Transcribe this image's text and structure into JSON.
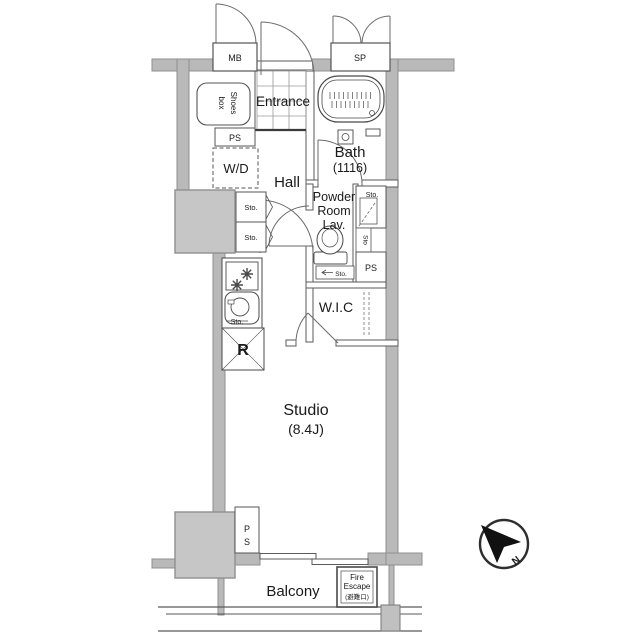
{
  "plan": {
    "type": "apartment-floor-plan",
    "colors": {
      "wall_fill": "#b9b9b9",
      "wall_edge": "#8f8f8f",
      "pillar_fill": "#c6c6c6",
      "line": "#3a3a3a",
      "text": "#1a1a1a",
      "background": "#ffffff"
    },
    "rooms": {
      "entrance": "Entrance",
      "hall": "Hall",
      "bath": "Bath",
      "bath_size": "(1116)",
      "powder_line1": "Powder",
      "powder_line2": "Room",
      "powder_line3": "Lav.",
      "wic": "W.I.C",
      "studio": "Studio",
      "studio_size": "(8.4J)",
      "balcony": "Balcony"
    },
    "fixtures": {
      "mb": "MB",
      "sp": "SP",
      "shoes_line1": "Shoes",
      "shoes_line2": "box",
      "ps_upper": "PS",
      "ps_right": "PS",
      "ps_lower_line1": "P",
      "ps_lower_line2": "S",
      "wd": "W/D",
      "sto_shelf_upper": "Sto.",
      "sto_shelf_lower": "Sto.",
      "sto_closet": "Sto.",
      "sto_closet_small": "Sto",
      "sto_vanity": "Sto.",
      "sto_kitchen": "Sto.",
      "refrigerator": "R",
      "fire_line1": "Fire",
      "fire_line2": "Escape",
      "fire_line3": "(避難口)",
      "compass_north": "N"
    }
  }
}
